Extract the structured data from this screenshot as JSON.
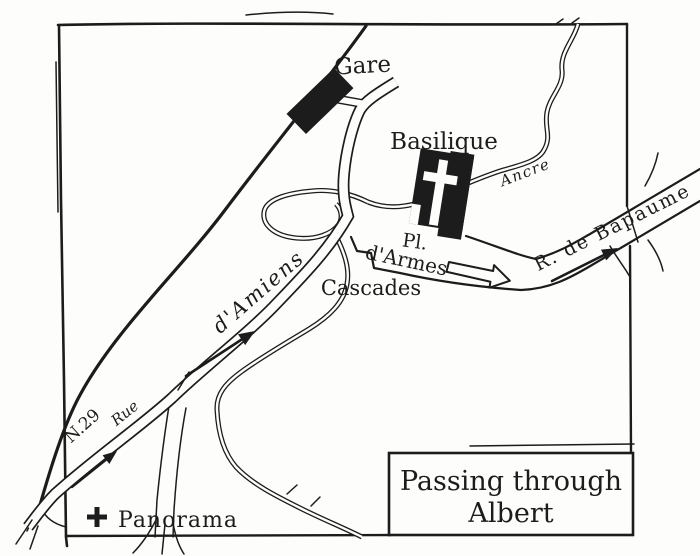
{
  "map": {
    "title_box": {
      "line1": "Passing through",
      "line2": "Albert"
    },
    "labels": {
      "gare": "Gare",
      "basilique": "Basilique",
      "river": "Ancre",
      "place_line1": "Pl.",
      "place_line2": "d'Armes",
      "cascades": "Cascades",
      "rue_bapaume": "R. de Bapaume",
      "rue_amiens": "d'Amiens",
      "rue": "Rue",
      "n29": "N.29",
      "panorama": "Panorama"
    },
    "colors": {
      "ink": "#1c1c1c",
      "paper": "#fdfdfb"
    }
  }
}
